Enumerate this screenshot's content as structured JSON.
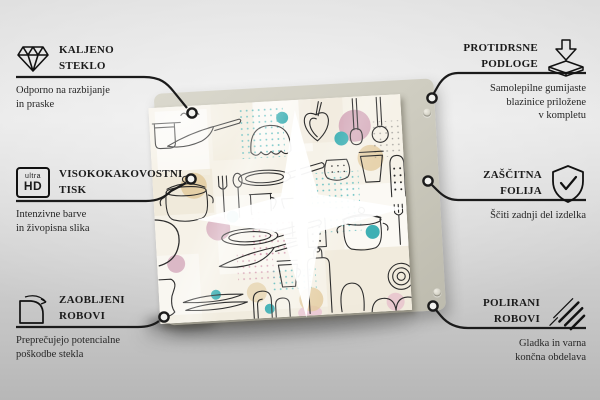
{
  "colors": {
    "background": "#e7e7e7",
    "callout_line": "#1b1b1b",
    "text": "#1b1b1b",
    "backing_board": "#cfcdc1",
    "glass_surface": "#f6f2e8",
    "pattern_ink": "#2d2d2d",
    "accent_pink": "#cf9db3",
    "accent_teal": "#3fb0b4",
    "accent_beige": "#e3cb9e"
  },
  "product": {
    "pattern": "kitchen-utensil-doodles"
  },
  "callouts": {
    "left": [
      {
        "icon": "diamond-icon",
        "title": [
          "KALJENO",
          "STEKLO"
        ],
        "subtitle": [
          "Odporno na razbijanje",
          "in praske"
        ]
      },
      {
        "icon": "ultra-hd-icon",
        "icon_text": [
          "ultra",
          "HD"
        ],
        "title": [
          "VISOKOKAKOVOSTNI",
          "TISK"
        ],
        "subtitle": [
          "Intenzivne barve",
          "in živopisna slika"
        ]
      },
      {
        "icon": "rounded-corner-icon",
        "title": [
          "ZAOBLJENI",
          "ROBOVI"
        ],
        "subtitle": [
          "Preprečujejo potencialne",
          "poškodbe stekla"
        ]
      }
    ],
    "right": [
      {
        "icon": "anti-slip-pads-icon",
        "title": [
          "PROTIDRSNE",
          "PODLOGE"
        ],
        "subtitle": [
          "Samolepilne gumijaste",
          "blazinice priložene",
          "v kompletu"
        ]
      },
      {
        "icon": "shield-check-icon",
        "title": [
          "ZAŠČITNA",
          "FOLIJA"
        ],
        "subtitle": [
          "Ščiti zadnji del izdelka"
        ]
      },
      {
        "icon": "polished-edges-icon",
        "title": [
          "POLIRANI",
          "ROBOVI"
        ],
        "subtitle": [
          "Gladka in varna",
          "končna obdelava"
        ]
      }
    ]
  }
}
